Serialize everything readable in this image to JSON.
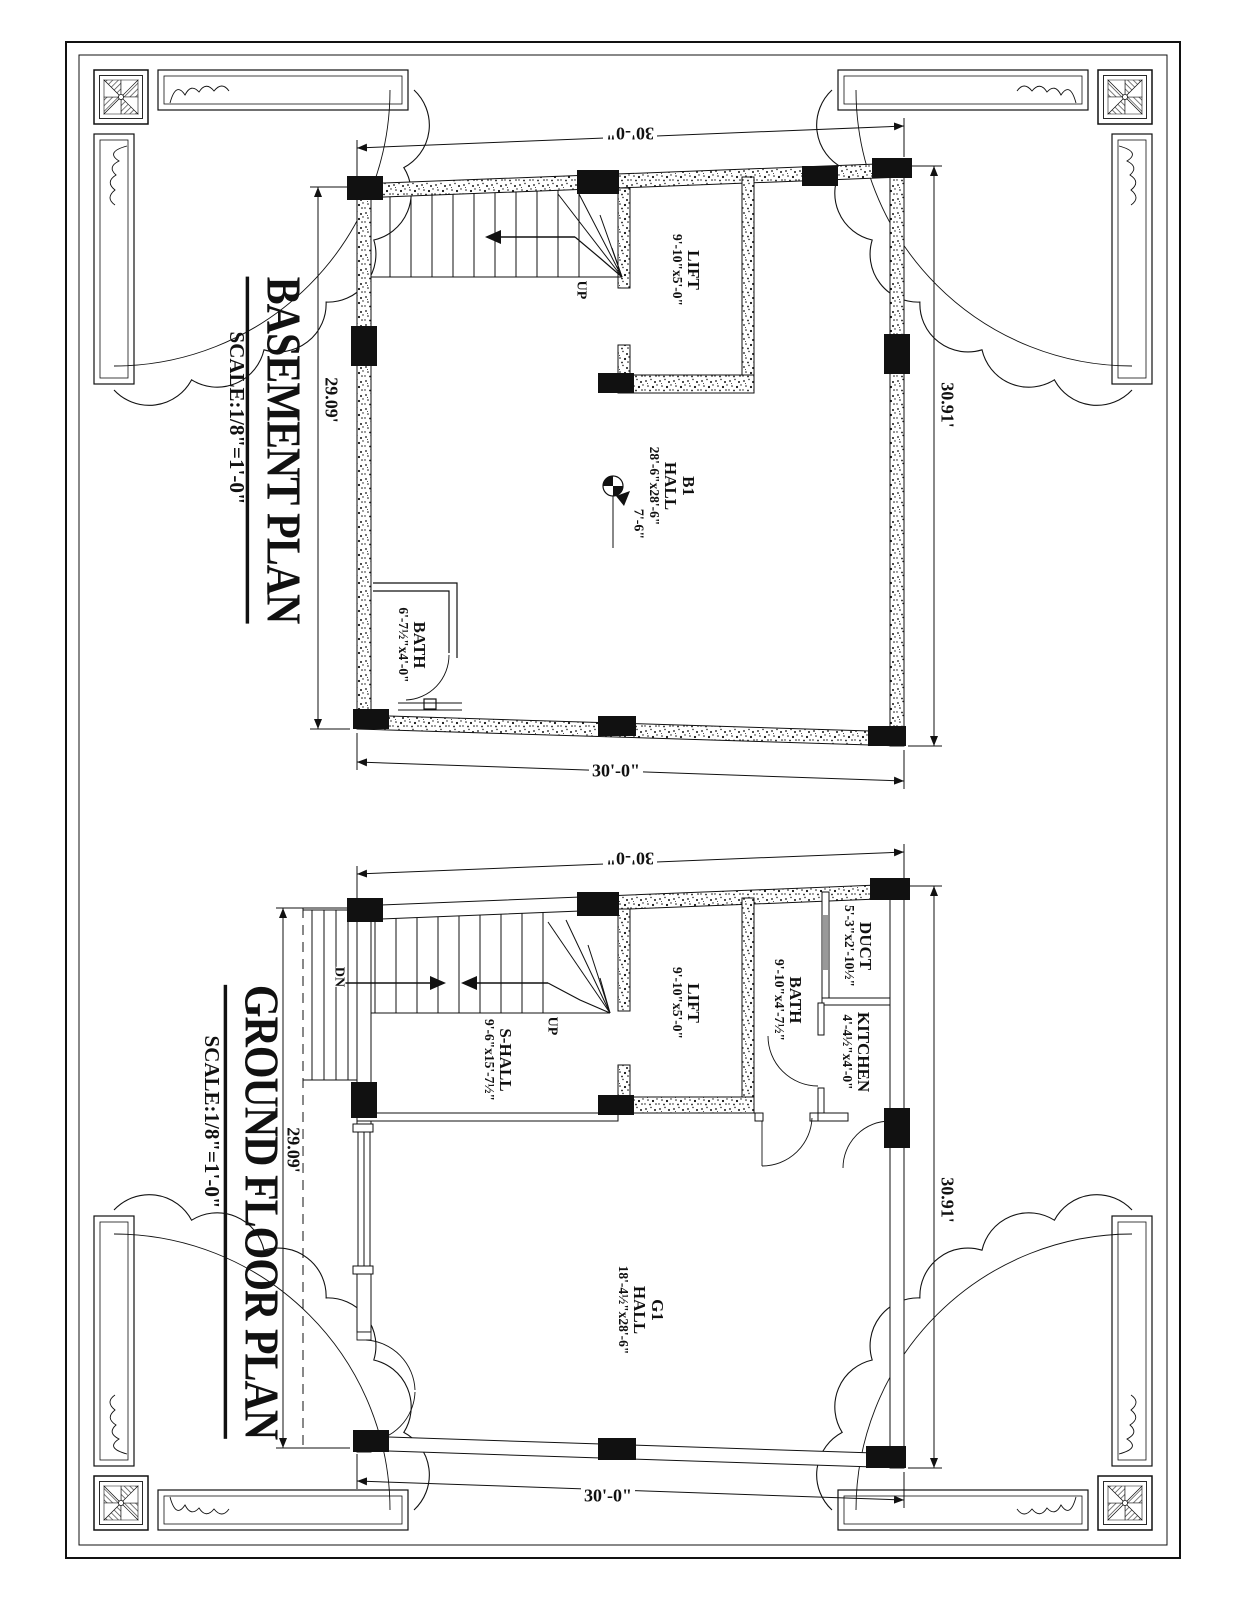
{
  "sheet": {
    "ink_color": "#111111",
    "paper_color": "#ffffff",
    "window_gray": "#999999"
  },
  "basement": {
    "title": "BASEMENT PLAN",
    "scale": "SCALE:1/8\"=1'-0\"",
    "dim_top": "30'-0\"",
    "dim_bottom": "30'-0\"",
    "dim_left": "29.09'",
    "dim_right": "30.91'",
    "hall_name": "B1",
    "hall_label": "HALL",
    "hall_size": "28'-6\"x28'-6\"",
    "lift_label": "LIFT",
    "lift_size": "9'-10\"x5'-0\"",
    "bath_label": "BATH",
    "bath_size": "6'-7½\"x4'-0\"",
    "up_label": "UP",
    "level_height": "7'-6\""
  },
  "ground": {
    "title": "GROUND FLOOR PLAN",
    "scale": "SCALE:1/8\"=1'-0\"",
    "dim_top": "30'-0\"",
    "dim_bottom": "30'-0\"",
    "dim_left": "29.09'",
    "dim_right": "30.91'",
    "hall_name": "G1",
    "hall_label": "HALL",
    "hall_size": "18'-4½\"x28'-6\"",
    "s_hall_label": "S-HALL",
    "s_hall_size": "9'-6\"x15'-7½\"",
    "lift_label": "LIFT",
    "lift_size": "9'-10\"x5'-0\"",
    "bath_label": "BATH",
    "bath_size": "9'-10\"x4'-7½\"",
    "duct_label": "DUCT",
    "duct_size": "5'-3\"x2'-10½\"",
    "kitchen_label": "KITCHEN",
    "kitchen_size": "4'-4½\"x4'-0\"",
    "up_label": "UP",
    "dn_label": "DN"
  }
}
